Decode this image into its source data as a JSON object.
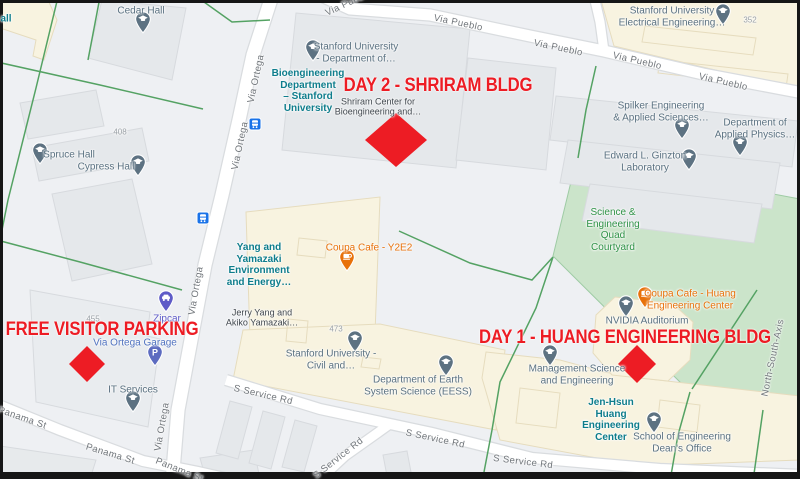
{
  "annotations": {
    "color": "#ed1c24",
    "day2_label": "DAY 2 - SHRIRAM BLDG",
    "day1_label": "DAY 1 - HUANG ENGINEERING BLDG",
    "parking_label": "FREE VISITOR PARKING",
    "marker_shape": "red-diamond"
  },
  "streets": {
    "via_pueblo": "Via Pueblo",
    "via_ortega": "Via Ortega",
    "panama_st": "Panama St",
    "s_service_rd": "S Service Rd",
    "north_south_axis": "North-South-Axis"
  },
  "pois": {
    "cedar_hall": {
      "lines": [
        "Cedar Hall"
      ]
    },
    "hall_partial": {
      "lines": [
        "all"
      ]
    },
    "spruce_hall": {
      "lines": [
        "Spruce Hall"
      ]
    },
    "cypress_hall": {
      "lines": [
        "Cypress Hall"
      ]
    },
    "su_department": {
      "lines": [
        "Stanford University",
        "- Department of…"
      ]
    },
    "bioengineering": {
      "lines": [
        "Bioengineering",
        "Department",
        "– Stanford",
        "University"
      ]
    },
    "shriram_center": {
      "lines": [
        "Shriram Center for",
        "Bioengineering and…"
      ]
    },
    "su_electrical": {
      "lines": [
        "Stanford University",
        "Electrical Engineering…"
      ]
    },
    "spilker": {
      "lines": [
        "Spilker Engineering",
        "& Applied Sciences…"
      ]
    },
    "applied_physics": {
      "lines": [
        "Department of",
        "Applied Physics…"
      ]
    },
    "ginzton": {
      "lines": [
        "Edward L. Ginzton",
        "Laboratory"
      ]
    },
    "quad": {
      "lines": [
        "Science &",
        "Engineering",
        "Quad",
        "Courtyard"
      ]
    },
    "yang_yamazaki": {
      "lines": [
        "Yang and",
        "Yamazaki",
        "Environment",
        "and Energy…"
      ]
    },
    "coupa_y2e2": {
      "lines": [
        "Coupa Cafe - Y2E2"
      ]
    },
    "jerry_yang": {
      "lines": [
        "Jerry Yang and",
        "Akiko Yamazaki…"
      ]
    },
    "su_civil": {
      "lines": [
        "Stanford University -",
        "Civil and…"
      ]
    },
    "eess": {
      "lines": [
        "Department of Earth",
        "System Science (EESS)"
      ]
    },
    "coupa_huang": {
      "lines": [
        "Coupa Cafe - Huang",
        "Engineering Center"
      ]
    },
    "nvidia": {
      "lines": [
        "NVIDIA Auditorium"
      ]
    },
    "mgmt_science": {
      "lines": [
        "Management Science",
        "and Engineering"
      ]
    },
    "jen_hsun": {
      "lines": [
        "Jen-Hsun",
        "Huang",
        "Engineering",
        "Center"
      ]
    },
    "deans_office": {
      "lines": [
        "School of Engineering",
        "Dean's Office"
      ]
    },
    "zipcar": {
      "lines": [
        "Zipcar"
      ]
    },
    "garage": {
      "lines": [
        "Via Ortega Garage"
      ]
    },
    "it_services": {
      "lines": [
        "IT Services"
      ]
    }
  },
  "building_numbers": {
    "n408": "408",
    "n455": "455",
    "n473": "473",
    "n352": "352"
  },
  "icons": {
    "parking_glyph": "P"
  },
  "colors": {
    "annotation_red": "#ed1c24",
    "poi_teal": "#0e7d8c",
    "cafe_orange": "#e8710a",
    "park_green_fill": "#cbe4ca",
    "park_label_green": "#2f9247",
    "poi_building_cream": "#f8f3e0",
    "road_white": "#ffffff",
    "zipcar_purple": "#5e5bc7",
    "garage_blue": "#5173c0",
    "pin_slate": "#5d7282",
    "transit_blue": "#1a73e8"
  }
}
